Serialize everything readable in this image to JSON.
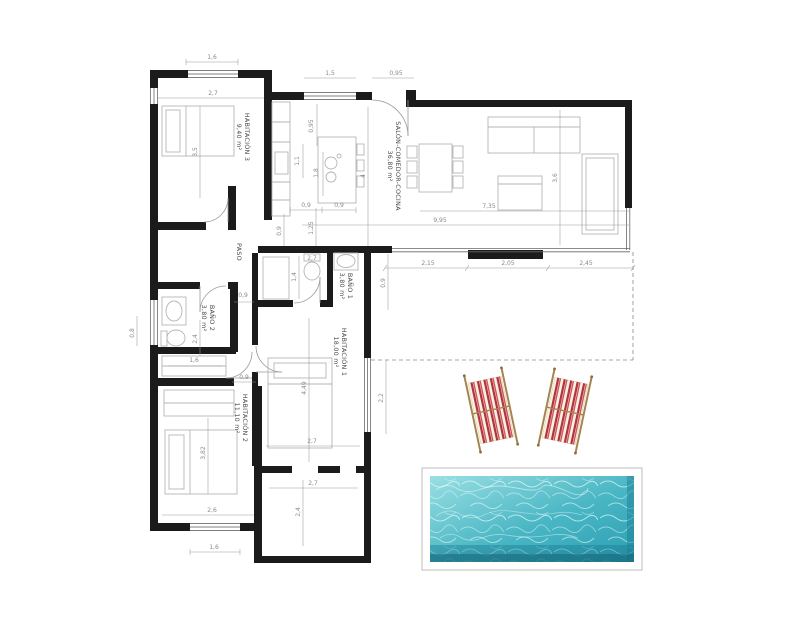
{
  "plan": {
    "rooms": {
      "hab3": {
        "name": "HABITACIÓN 3",
        "area": "9,40 m²"
      },
      "salon": {
        "name": "SALÓN-COMEDOR-COCINA",
        "area": "36,80 m²"
      },
      "paso": {
        "name": "PASO",
        "area": ""
      },
      "bano1": {
        "name": "BAÑO 1",
        "area": "3,80 m²"
      },
      "bano2": {
        "name": "BAÑO 2",
        "area": "3,80 m²"
      },
      "hab1": {
        "name": "HABITACIÓN 1",
        "area": "18,00 m²"
      },
      "hab2": {
        "name": "HABITACIÓN 2",
        "area": "11,10 m²"
      }
    },
    "dimensions": [
      {
        "text": "1,6",
        "x": 212,
        "y": 59,
        "rot": 0
      },
      {
        "text": "2,7",
        "x": 213,
        "y": 95,
        "rot": 0
      },
      {
        "text": "1,5",
        "x": 330,
        "y": 75,
        "rot": 0
      },
      {
        "text": "0,95",
        "x": 396,
        "y": 75,
        "rot": 0
      },
      {
        "text": "3,5",
        "x": 197,
        "y": 152,
        "rot": -90
      },
      {
        "text": "0,95",
        "x": 313,
        "y": 126,
        "rot": -90
      },
      {
        "text": "1,1",
        "x": 299,
        "y": 161,
        "rot": -90
      },
      {
        "text": "1,8",
        "x": 318,
        "y": 173,
        "rot": -90
      },
      {
        "text": "4",
        "x": 365,
        "y": 176,
        "rot": -90
      },
      {
        "text": "0,9",
        "x": 306,
        "y": 207,
        "rot": 0
      },
      {
        "text": "0,9",
        "x": 339,
        "y": 207,
        "rot": 0
      },
      {
        "text": "7,35",
        "x": 489,
        "y": 208,
        "rot": 0
      },
      {
        "text": "9,95",
        "x": 440,
        "y": 222,
        "rot": 0
      },
      {
        "text": "3,6",
        "x": 557,
        "y": 178,
        "rot": -90
      },
      {
        "text": "0,9",
        "x": 281,
        "y": 231,
        "rot": -90
      },
      {
        "text": "1,25",
        "x": 313,
        "y": 228,
        "rot": -90
      },
      {
        "text": "0,9",
        "x": 243,
        "y": 297,
        "rot": 0
      },
      {
        "text": "2,7",
        "x": 312,
        "y": 260,
        "rot": 0
      },
      {
        "text": "1,4",
        "x": 296,
        "y": 277,
        "rot": -90
      },
      {
        "text": "0,9",
        "x": 385,
        "y": 283,
        "rot": -90
      },
      {
        "text": "2,15",
        "x": 428,
        "y": 265,
        "rot": 0
      },
      {
        "text": "2,05",
        "x": 508,
        "y": 265,
        "rot": 0
      },
      {
        "text": "2,45",
        "x": 586,
        "y": 265,
        "rot": 0
      },
      {
        "text": "0,8",
        "x": 134,
        "y": 333,
        "rot": -90
      },
      {
        "text": "2,4",
        "x": 197,
        "y": 339,
        "rot": -90
      },
      {
        "text": "1,6",
        "x": 194,
        "y": 362,
        "rot": 0
      },
      {
        "text": "0,9",
        "x": 244,
        "y": 379,
        "rot": 0
      },
      {
        "text": "4,49",
        "x": 306,
        "y": 388,
        "rot": -90
      },
      {
        "text": "2,2",
        "x": 383,
        "y": 398,
        "rot": -90
      },
      {
        "text": "3,82",
        "x": 205,
        "y": 453,
        "rot": -90
      },
      {
        "text": "2,7",
        "x": 312,
        "y": 443,
        "rot": 0
      },
      {
        "text": "2,7",
        "x": 313,
        "y": 485,
        "rot": 0
      },
      {
        "text": "2,4",
        "x": 300,
        "y": 512,
        "rot": -90
      },
      {
        "text": "2,6",
        "x": 212,
        "y": 512,
        "rot": 0
      },
      {
        "text": "1,6",
        "x": 214,
        "y": 549,
        "rot": 0
      }
    ]
  },
  "colors": {
    "wall": "#1b1b1b",
    "furniture": "#b5b5b5",
    "dimension": "#8a8a8a",
    "pool_light": "#9adfe3",
    "pool_dark": "#2b9fb3",
    "chair_stripe": "#b03441",
    "chair_fabric": "#faf2e0",
    "chair_frame": "#a5854f"
  }
}
